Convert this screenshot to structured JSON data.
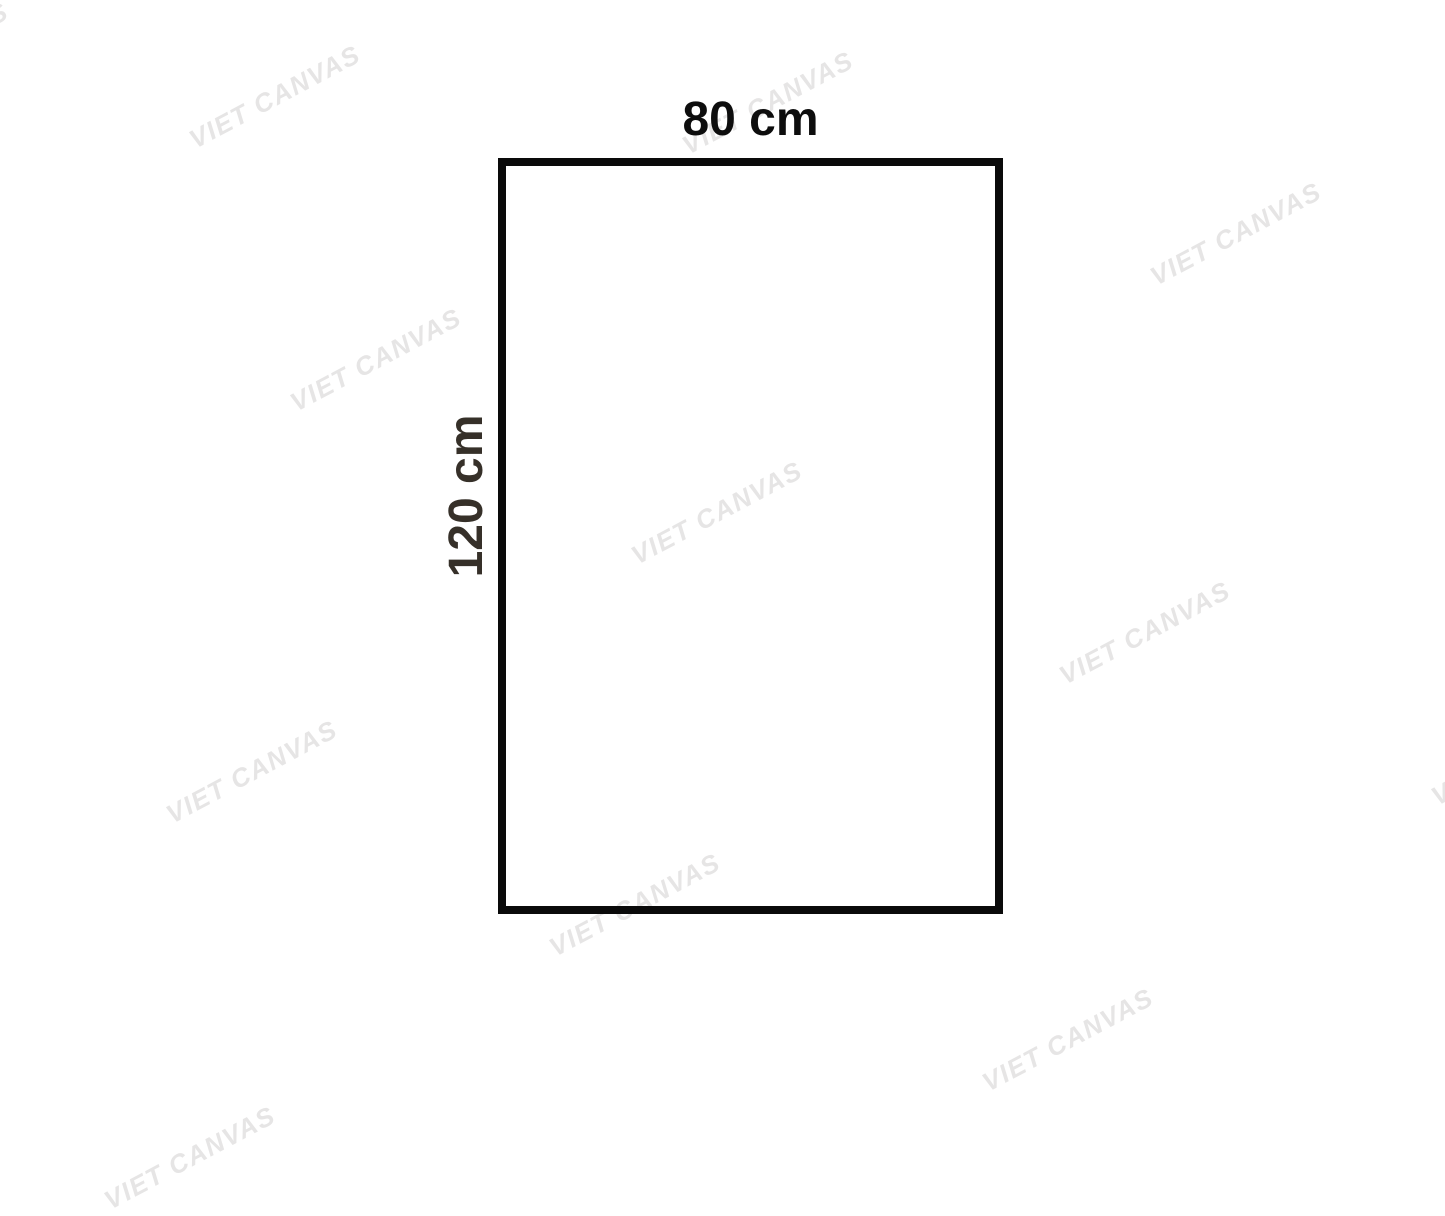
{
  "diagram": {
    "width_label": "80 cm",
    "height_label": "120 cm",
    "border_color": "#0a0a0a",
    "width_label_color": "#0d0d0d",
    "height_label_color": "#363029",
    "background_color": "#ffffff"
  },
  "watermark": {
    "text": "VIET CANVAS",
    "color": "#e6e5e5",
    "rotation_deg": -28,
    "positions": [
      {
        "x": 275,
        "y": 97
      },
      {
        "x": 768,
        "y": 103
      },
      {
        "x": 1236,
        "y": 234
      },
      {
        "x": 376,
        "y": 360
      },
      {
        "x": 717,
        "y": 513
      },
      {
        "x": 1145,
        "y": 633
      },
      {
        "x": 252,
        "y": 772
      },
      {
        "x": 635,
        "y": 905
      },
      {
        "x": 1068,
        "y": 1040
      },
      {
        "x": 190,
        "y": 1158
      },
      {
        "x": 1517,
        "y": 754
      },
      {
        "x": -77,
        "y": 54
      }
    ]
  }
}
